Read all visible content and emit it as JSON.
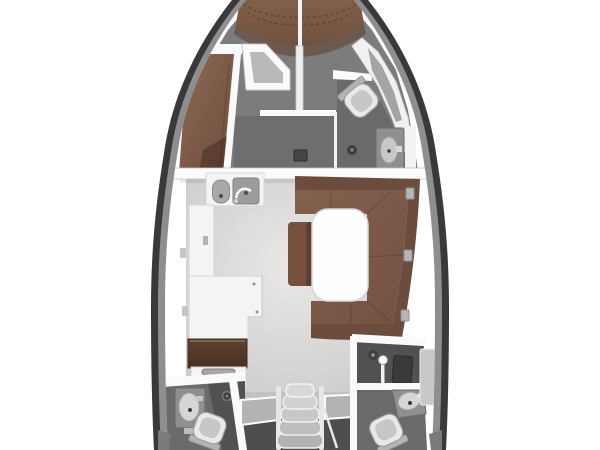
{
  "meta": {
    "subject": "sailing-yacht-interior-floor-plan",
    "view": "top-down",
    "orientation": "bow-at-top",
    "background": "#ffffff"
  },
  "canvas": {
    "width": 600,
    "height": 450
  },
  "colors": {
    "hull_outline": "#39383a",
    "hull_inner_band": "#8e8d90",
    "deck_gray": "#7c7b7d",
    "cabin_floor": "#6e6d70",
    "head_floor": "#6a696c",
    "shower_floor": "#515053",
    "aft_floor_dark": "#4e4d50",
    "companionway_floor": "#c2c1c4",
    "saloon_floor": "#d4d3d1",
    "bulkhead_white": "#fafafa",
    "counter_white": "#f4f3f5",
    "cushion_brown": "#7e5b4a",
    "cushion_brown_dark": "#6b4c3d",
    "wood_brown": "#55392b",
    "fixture_gray": "#8f8e91",
    "basin_light": "#d6d5d8",
    "drain_dark": "#3e3d40",
    "table_white": "#fefefe"
  },
  "legend": {
    "hull": "yacht hull outline",
    "bow": "V-berth cushions at bow",
    "port_forward": "port forward berth with wardrobe",
    "starboard_forward": "forward head with toilet, shower drain and washbasin",
    "galley": "port galley with twin sinks, counters, wood worktop and stove",
    "saloon": "saloon with L-shaped settee, table and bench",
    "aft_port": "aft port head with washbasin, shower drain and toilet",
    "companionway": "companionway steps with side hatches",
    "aft_starboard": "aft starboard shower stall and head with washbasin and toilet"
  },
  "counts": {
    "companionway_steps": 5,
    "toilets": 3,
    "washbasins": 4,
    "shower_drains": 3,
    "galley_sinks": 2
  }
}
